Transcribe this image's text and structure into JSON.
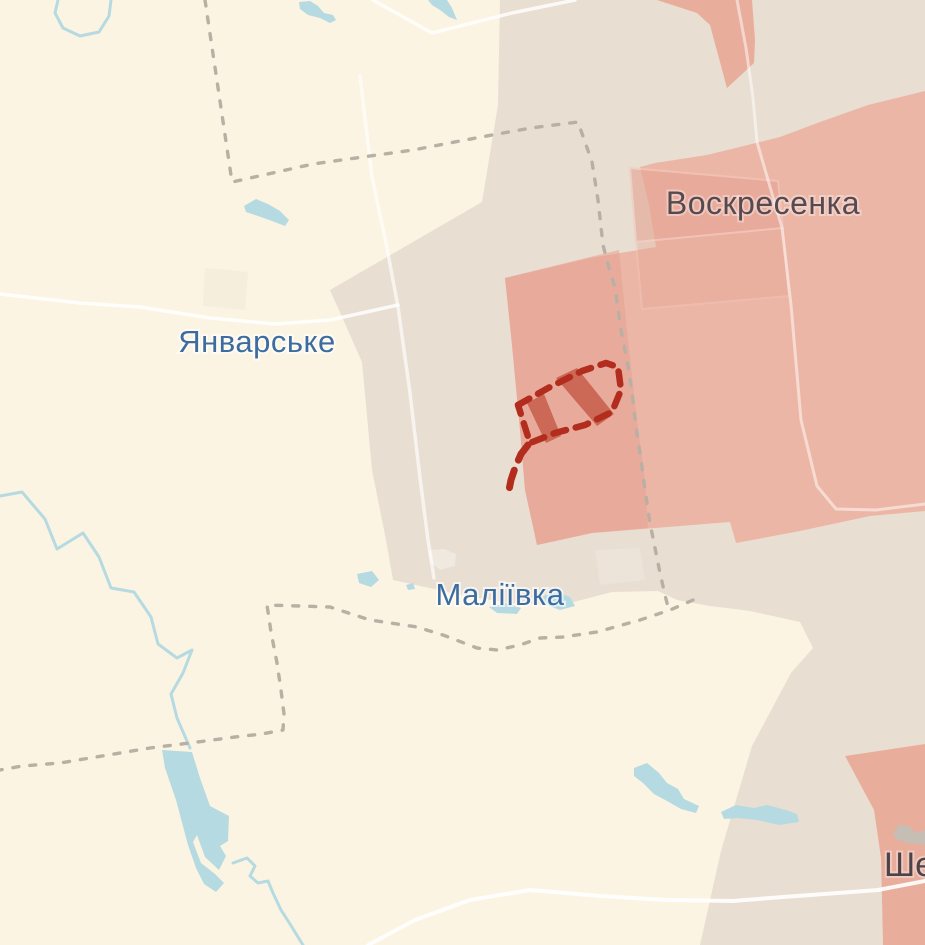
{
  "map": {
    "labels": {
      "settlement_nw": "Январське",
      "settlement_center": "Маліївка",
      "settlement_ne": "Воскресенка",
      "settlement_se_partial": "Ше"
    },
    "colors": {
      "background": "#fbf4e2",
      "gray_zone": "#e8ded2",
      "occupied": "#ecb6a7",
      "occupied_dark": "#e6a392",
      "occupied_wedge": "#e9ad9c",
      "village_border": "#f3c8bc",
      "water": "#b6dae1",
      "road": "#ffffff",
      "admin_boundary": "#b8b0a4",
      "assault_outline": "#b32d1e",
      "assault_hatch": "#c8604f",
      "settlement_label": "#3c6d9e",
      "occupied_label": "#564950",
      "occupied_label_se": "#4c4349",
      "footprint_gray": "#c6bdb4",
      "footprint_light": "#f0e9df",
      "footprint_faint": "#f6eedd",
      "gray_zone_light": "#ece4d9"
    }
  }
}
